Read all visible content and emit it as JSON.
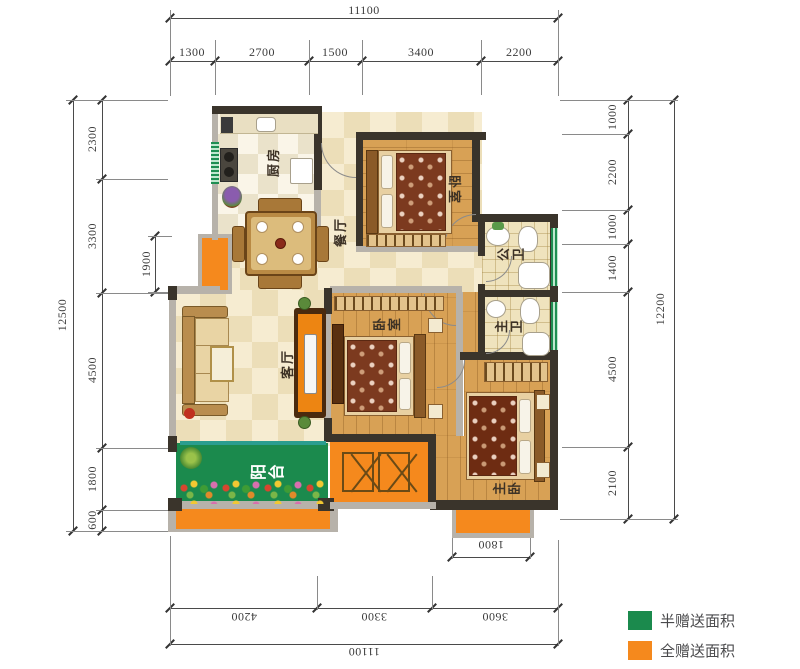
{
  "rooms": {
    "kitchen": "厨房",
    "dining": "餐厅",
    "bedroom_top": "卧室",
    "public_bath": "公卫",
    "master_bath": "主卫",
    "living": "客厅",
    "bedroom_mid": "卧室",
    "balcony": "阳台",
    "master_bedroom": "主卧"
  },
  "dimensions": {
    "top": {
      "total": "11100",
      "segments": [
        "1300",
        "2700",
        "1500",
        "3400",
        "2200"
      ]
    },
    "left": {
      "total": "12500",
      "segments": [
        "2300",
        "3300",
        "4500",
        "1800",
        "600"
      ],
      "inner": "1900"
    },
    "right": {
      "total": "12200",
      "segments": [
        "1000",
        "2200",
        "1000",
        "1400",
        "4500",
        "2100"
      ]
    },
    "bottom": {
      "total": "11100",
      "segments": [
        "4200",
        "3300",
        "3600"
      ],
      "inner": "1800"
    }
  },
  "legend": {
    "items": [
      {
        "label": "半赠送面积",
        "color": "#1b8a4d"
      },
      {
        "label": "全赠送面积",
        "color": "#f5891d"
      }
    ]
  },
  "colors": {
    "half_gift": "#1b8a4d",
    "full_gift": "#f5891d",
    "wall_dark": "#3a342b",
    "wall_gray": "#b7b2aa"
  }
}
